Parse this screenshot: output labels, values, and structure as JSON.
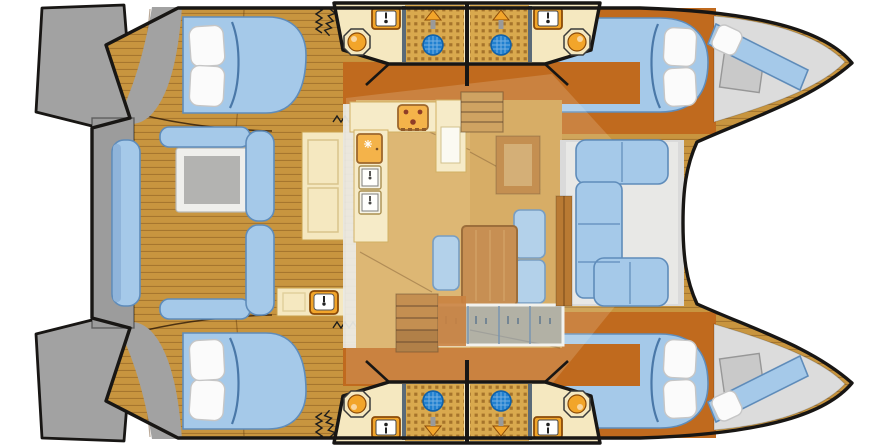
{
  "meta": {
    "title": "Catamaran interior layout floor plan, bow to the right",
    "type": "floor-plan",
    "orientation": {
      "bow": "right",
      "stern": "left"
    }
  },
  "colors": {
    "outline": "#181614",
    "teak": "#c8953f",
    "plank_line": "#6e4512",
    "wood_dark": "#c06a1e",
    "wood_med": "#b97a33",
    "wood_table": "#bd7a35",
    "cream": "#f5e8c0",
    "cream_border": "#c9a14b",
    "orange": "#f2a52a",
    "orange_deep": "#8a4a08",
    "blue": "#a5c9e9",
    "blue_shade": "#8fb4da",
    "blue_edge": "#5f8cba",
    "glass": "#7fa8d5",
    "drain": "#2080d0",
    "tile": "#d9a94e",
    "tile_dot": "#95621f",
    "gray": "#a2a2a2",
    "gray_beam": "#9c9c9c",
    "gray_deck": "#dadada",
    "gray_deck_light": "#e8e8e6",
    "table_top": "#b3b3b1",
    "white": "#ffffff"
  },
  "areas": {
    "stern": {
      "platforms": [
        "port swim platform",
        "starboard swim platform"
      ],
      "crossbeam": "aft crossbeam walkway"
    },
    "cockpit": {
      "floor": "teak plank deck",
      "furniture": [
        "cockpit table with gray top",
        "forward L-bench",
        "aft L-bench",
        "transom bench",
        "wet-bar counter with sink",
        "cockpit cabinet"
      ]
    },
    "hulls": [
      {
        "side": "port (top)",
        "spaces": [
          "aft double cabin with pillows",
          "head: toilet, basin, shower with drain",
          "forward double cabin with pillows",
          "forepeak berth with locker"
        ]
      },
      {
        "side": "starboard (bottom)",
        "spaces": [
          "aft double cabin with pillows",
          "head: toilet, basin, shower with drain",
          "forward double cabin with pillows",
          "forepeak berth with locker"
        ]
      }
    ],
    "heads_popouts": {
      "count": 2,
      "note": "each pop-out block holds two mirrored bathrooms joined by leader lines to the hulls",
      "fixtures_per_bath": [
        "toilet",
        "wash basin with faucet",
        "tiled shower floor",
        "blue drain",
        "shower head"
      ]
    },
    "salon": {
      "furniture": [
        "L-shaped galley counter",
        "three-burner stove",
        "refrigerator",
        "double sink",
        "tall cream cabinet",
        "dining table",
        "three blue dining seats",
        "navigation cabinet",
        "glass window console",
        "companionway stairs to port hull",
        "companionway stairs to starboard hull",
        "sliding-door springs"
      ]
    },
    "foredeck": {
      "deck": "gray lounge deck",
      "furniture": [
        "C-shaped blue lounge sofa"
      ]
    },
    "trampoline": "white bow trampoline between the hulls"
  }
}
